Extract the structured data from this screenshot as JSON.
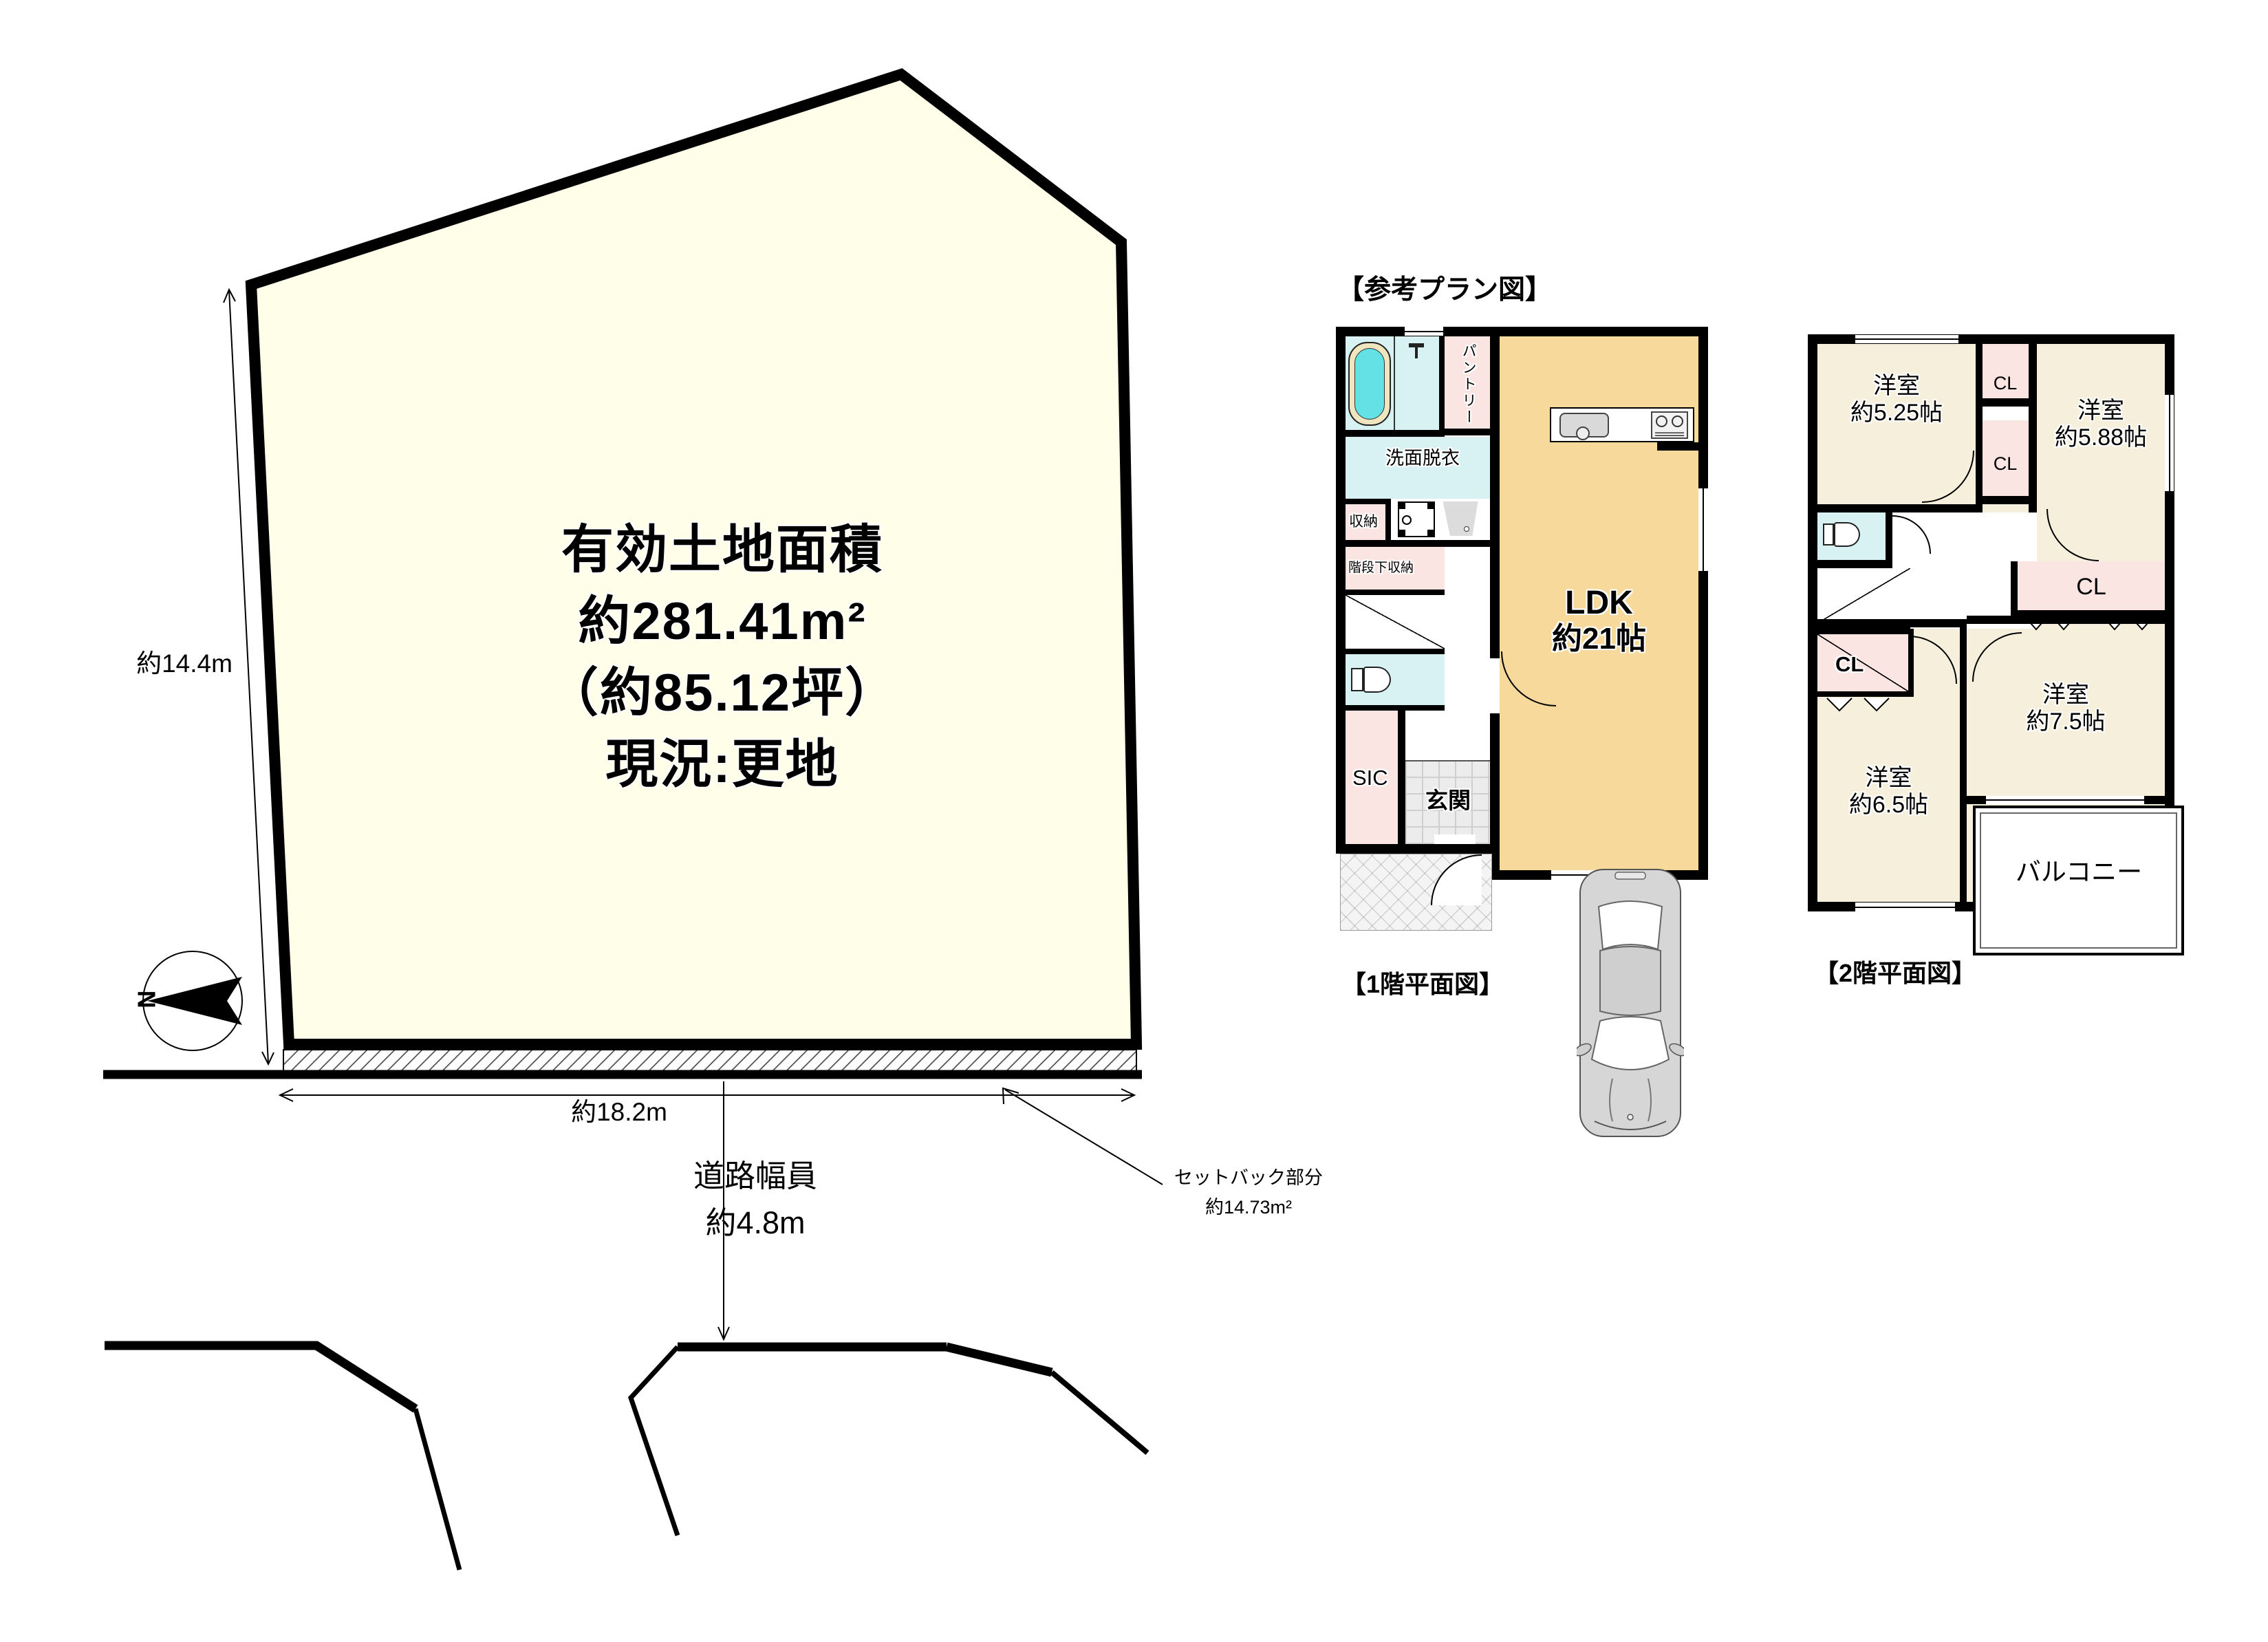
{
  "colors": {
    "plot_fill": "#FFFEE9",
    "ldk_fill": "#F6D99B",
    "room_fill": "#F6EFDC",
    "closet_fill": "#FBE5E3",
    "wet_fill": "#D8F2F4",
    "tub_fill": "#63E1E4",
    "wall": "#000000"
  },
  "land": {
    "area_lines": [
      "有効土地面積",
      "約281.41m²",
      "（約85.12坪）",
      "現況:更地"
    ],
    "dim_left": "約14.4m",
    "dim_bottom": "約18.2m",
    "road_width_1": "道路幅員",
    "road_width_2": "約4.8m",
    "setback_1": "セットバック部分",
    "setback_2": "約14.73m²",
    "north": "N"
  },
  "plans": {
    "header": "【参考プラン図】",
    "f1": {
      "caption": "【1階平面図】",
      "ldk_1": "LDK",
      "ldk_2": "約21帖",
      "pantry": "パントリー",
      "washroom": "洗面脱衣",
      "storage": "収納",
      "under_stairs": "階段下収納",
      "sic": "SIC",
      "entrance": "玄関"
    },
    "f2": {
      "caption": "【2階平面図】",
      "room_525_1": "洋室",
      "room_525_2": "約5.25帖",
      "room_588_1": "洋室",
      "room_588_2": "約5.88帖",
      "room_75_1": "洋室",
      "room_75_2": "約7.5帖",
      "room_65_1": "洋室",
      "room_65_2": "約6.5帖",
      "cl": "CL",
      "balcony": "バルコニー"
    }
  }
}
